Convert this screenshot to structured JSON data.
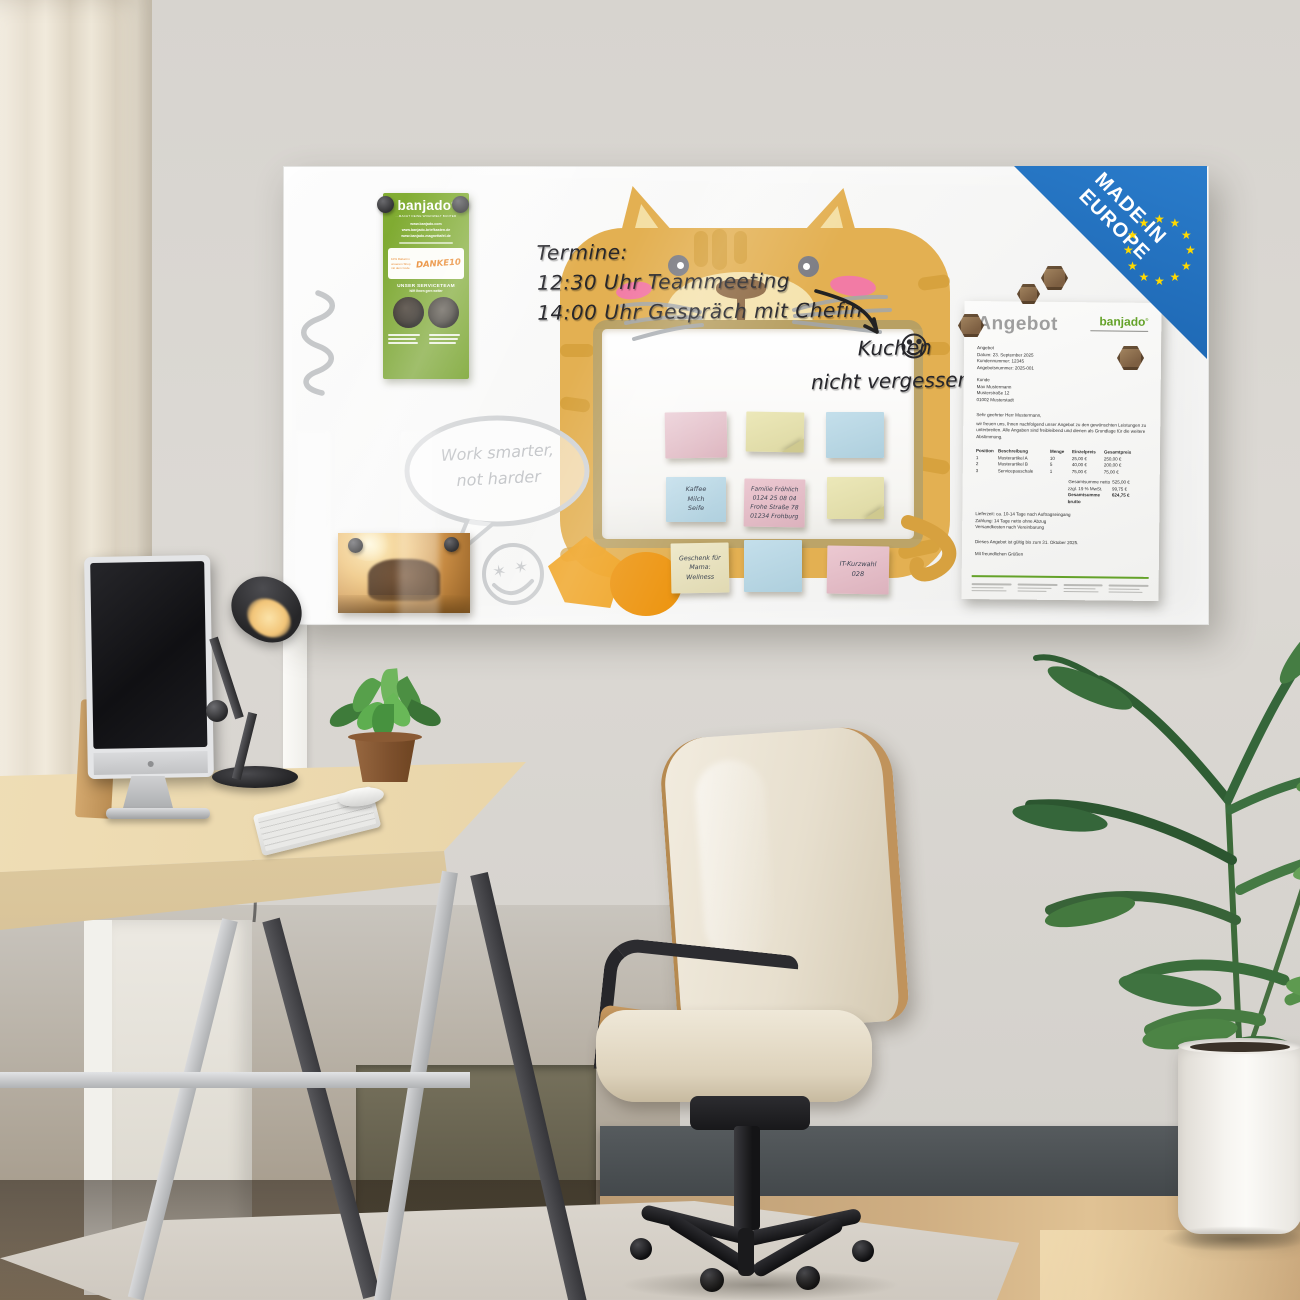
{
  "palette": {
    "cat_orange": "#E3B052",
    "cat_stripe": "#D29C36",
    "cat_cream": "#F5E3AE",
    "corner_blue": "#1E6FC0",
    "star_yellow": "#FFD900",
    "flyer_green": "#7CA62F",
    "logo_green": "#64A229",
    "note_pink": "#E2BEC6",
    "note_blue": "#BCD9E6",
    "note_yellow": "#E9E4B4",
    "note_cream": "#EBE6C4"
  },
  "board": {
    "flyer": {
      "logo": "banjado",
      "registered": "®",
      "tagline": "...MACHT DEINE WOHNWELT BUNTER",
      "urls": [
        "www.banjado.com",
        "www.banjado-briefkasten.de",
        "www.banjado-magnettafel.de"
      ],
      "discount_text": "10% Rabatt in unserem Shop mit dem Code",
      "discount_code": "DANKE10",
      "service_title": "UNSER SERVICETEAM",
      "service_sub": "hilft Ihnen gern weiter"
    },
    "handwriting": {
      "termine": [
        "Termine:",
        "12:30 Uhr Teammeeting",
        "14:00 Uhr Gespräch mit Chefin"
      ],
      "kuchen": [
        "Kuchen",
        "nicht vergessen"
      ],
      "bubble": [
        "Work smarter,",
        "not harder"
      ]
    },
    "notes": {
      "kaffee": [
        "Kaffee",
        "Milch",
        "Seife"
      ],
      "familie": [
        "Familie Fröhlich",
        "0124 25 08 04",
        "Frohe Straße 78",
        "01234 Frohburg"
      ],
      "geschenk": [
        "Geschenk für",
        "Mama:",
        "Wellness"
      ],
      "kurzwahl": [
        "IT-Kurzwahl",
        "028"
      ]
    },
    "badge": {
      "line1": "MADE IN",
      "line2": "EUROPE"
    },
    "document": {
      "title": "Angebot",
      "logo": "banjado",
      "registered": "®",
      "meta": [
        "Angebot",
        "Datum: 23. September 2025",
        "Kundennummer: 12345",
        "Angebotsnummer: 2025-001"
      ],
      "customer": [
        "Kunde",
        "Max Mustermann",
        "Musterstraße 12",
        "01002 Musterstadt"
      ],
      "salutation": "Sehr geehrter Herr Mustermann,",
      "intro": "wir freuen uns, Ihnen nachfolgend unser Angebot zu den gewünschten Leistungen zu unterbreiten. Alle Angaben sind freibleibend und dienen als Grundlage für die weitere Abstimmung.",
      "table": {
        "headers": [
          "Position",
          "Beschreibung",
          "Menge",
          "Einzelpreis",
          "Gesamtpreis"
        ],
        "rows": [
          [
            "1",
            "Musterartikel A",
            "10",
            "25,00 €",
            "250,00 €"
          ],
          [
            "2",
            "Musterartikel B",
            "5",
            "40,00 €",
            "200,00 €"
          ],
          [
            "3",
            "Servicepauschale",
            "1",
            "75,00 €",
            "75,00 €"
          ]
        ],
        "totals": [
          [
            "Gesamtsumme netto",
            "525,00 €"
          ],
          [
            "zzgl. 19 % MwSt.",
            "99,75 €"
          ],
          [
            "Gesamtsumme brutto",
            "624,75 €"
          ]
        ]
      },
      "terms": [
        "Lieferzeit: ca. 10-14 Tage nach Auftragseingang",
        "Zahlung: 14 Tage netto ohne Abzug",
        "Versandkosten nach Vereinbarung"
      ],
      "validity": "Dieses Angebot ist gültig bis zum 31. Oktober 2025.",
      "closing": "Mit freundlichen Grüßen"
    }
  }
}
